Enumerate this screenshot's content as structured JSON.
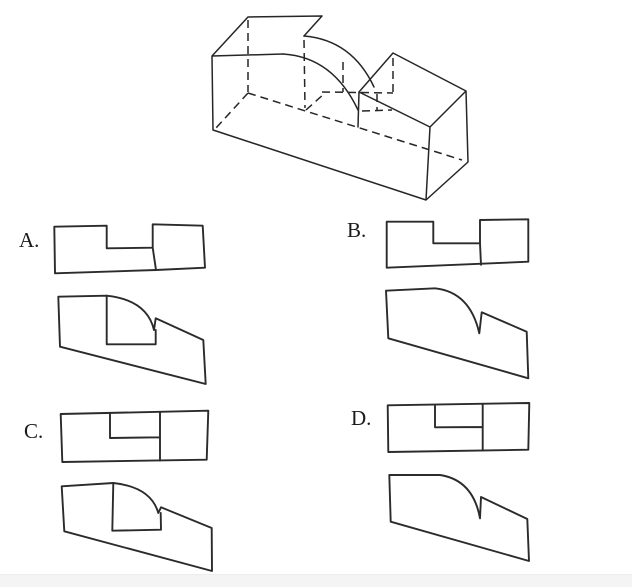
{
  "page": {
    "background": "#ffffff",
    "footer_strip_color": "#f4f4f4",
    "line_color": "#262626"
  },
  "figure": {
    "name": "isometric-pictorial",
    "description": "Isometric drawing of a rectangular block with a lower step on the right and a quarter-round notch cut between the tall and low portions; hidden edges shown dashed."
  },
  "options": [
    {
      "id": "A",
      "label": "A.",
      "views": "stepped top view with open notch; front view with inner rectangle and quarter-round curve"
    },
    {
      "id": "B",
      "label": "B.",
      "views": "stepped top view with open notch; plain front view with quarter-round curve and cusp"
    },
    {
      "id": "C",
      "label": "C.",
      "views": "full rectangle top view with inner notch lines; front view with inner rectangle and quarter-round curve"
    },
    {
      "id": "D",
      "label": "D.",
      "views": "full rectangle top view with inner notch lines; plain front view with quarter-round curve and cusp"
    }
  ],
  "paths": {
    "iso_solid": "M212 56 L248 17 L322 16 L304 36 M212 56 L283 54 M212 56 L213 130 L426 200 M430 127 L426 200 L468 162 M466 91 L468 162 M359 92 L393 53 L466 91 L430 127 Z M359 92 L358 127",
    "iso_arc_front": "M283 54 Q333 57 358 110",
    "iso_arc_back": "M304 36 Q352 40 374 87",
    "iso_hidden": "M248 20 L248 92 M248 93 L462 160 M248 93 L216 128 M304 40 L305 108 M306 110 L325 93 M322 92 L393 93 M393 58 L393 92 M343 62 L343 92 M362 111 L392 110 M377 94 L377 110",
    "a_top_outline": "M54.3 226.7 L106.7 225.7 L106.7 248.3 L152.7 247.7 L152.7 224.3 L202.7 225.7 L205 267.7 L156 270 L55 273.3 Z",
    "a_top_inner": "M152.7 247.7 L156 270",
    "a_front_outline": "M58.3 296.7 L106.7 295.7 Q147 300 154 330 L155.7 318.3 L203.3 340 L205.7 384 L60 346.7 Z",
    "a_front_inner": "M106.7 295.7 L106.7 344.3 L155.7 344.3 L155.7 330",
    "b_top_outline": "M386.7 221.7 L433.3 221.7 L433.3 243.3 L480 243.3 L480 220 L528.3 219.3 L528.3 261.7 L386.7 267.7 Z",
    "b_top_inner": "M480 243.3 L481 264.8",
    "b_front_outline": "M386 290.7 L435 288.3 Q470 292 479.3 333.3 L481.7 312.3 L526.7 331.7 L528.3 378.3 L388.3 338.3 Z",
    "c_top_outline": "M60.7 414 L208.3 410.7 L206.7 459.7 L62.3 462 Z",
    "c_top_inner": "M110 414.3 L110 438 L159.5 437.3 M160 412.7 L160 460.5",
    "c_front_outline": "M61.7 486.3 L113.3 483 Q151 487 158.3 513 L161 507.3 L211.7 528 L212 571 L64.3 531.3 Z",
    "c_front_inner": "M113.3 483 L112.3 530.7 L161 529.7 L160.7 513",
    "d_top_outline": "M387.7 405.3 L529.3 403 L528.3 449.7 L388.3 452 Z",
    "d_top_inner": "M435 406 L435 427.3 L482.7 427 M482.7 404 L482.7 450.5",
    "d_front_outline": "M389.3 475 L440 475 Q473 480 480 518.3 L481 497 L527.3 519 L529 561 L390.7 521.7 Z"
  }
}
